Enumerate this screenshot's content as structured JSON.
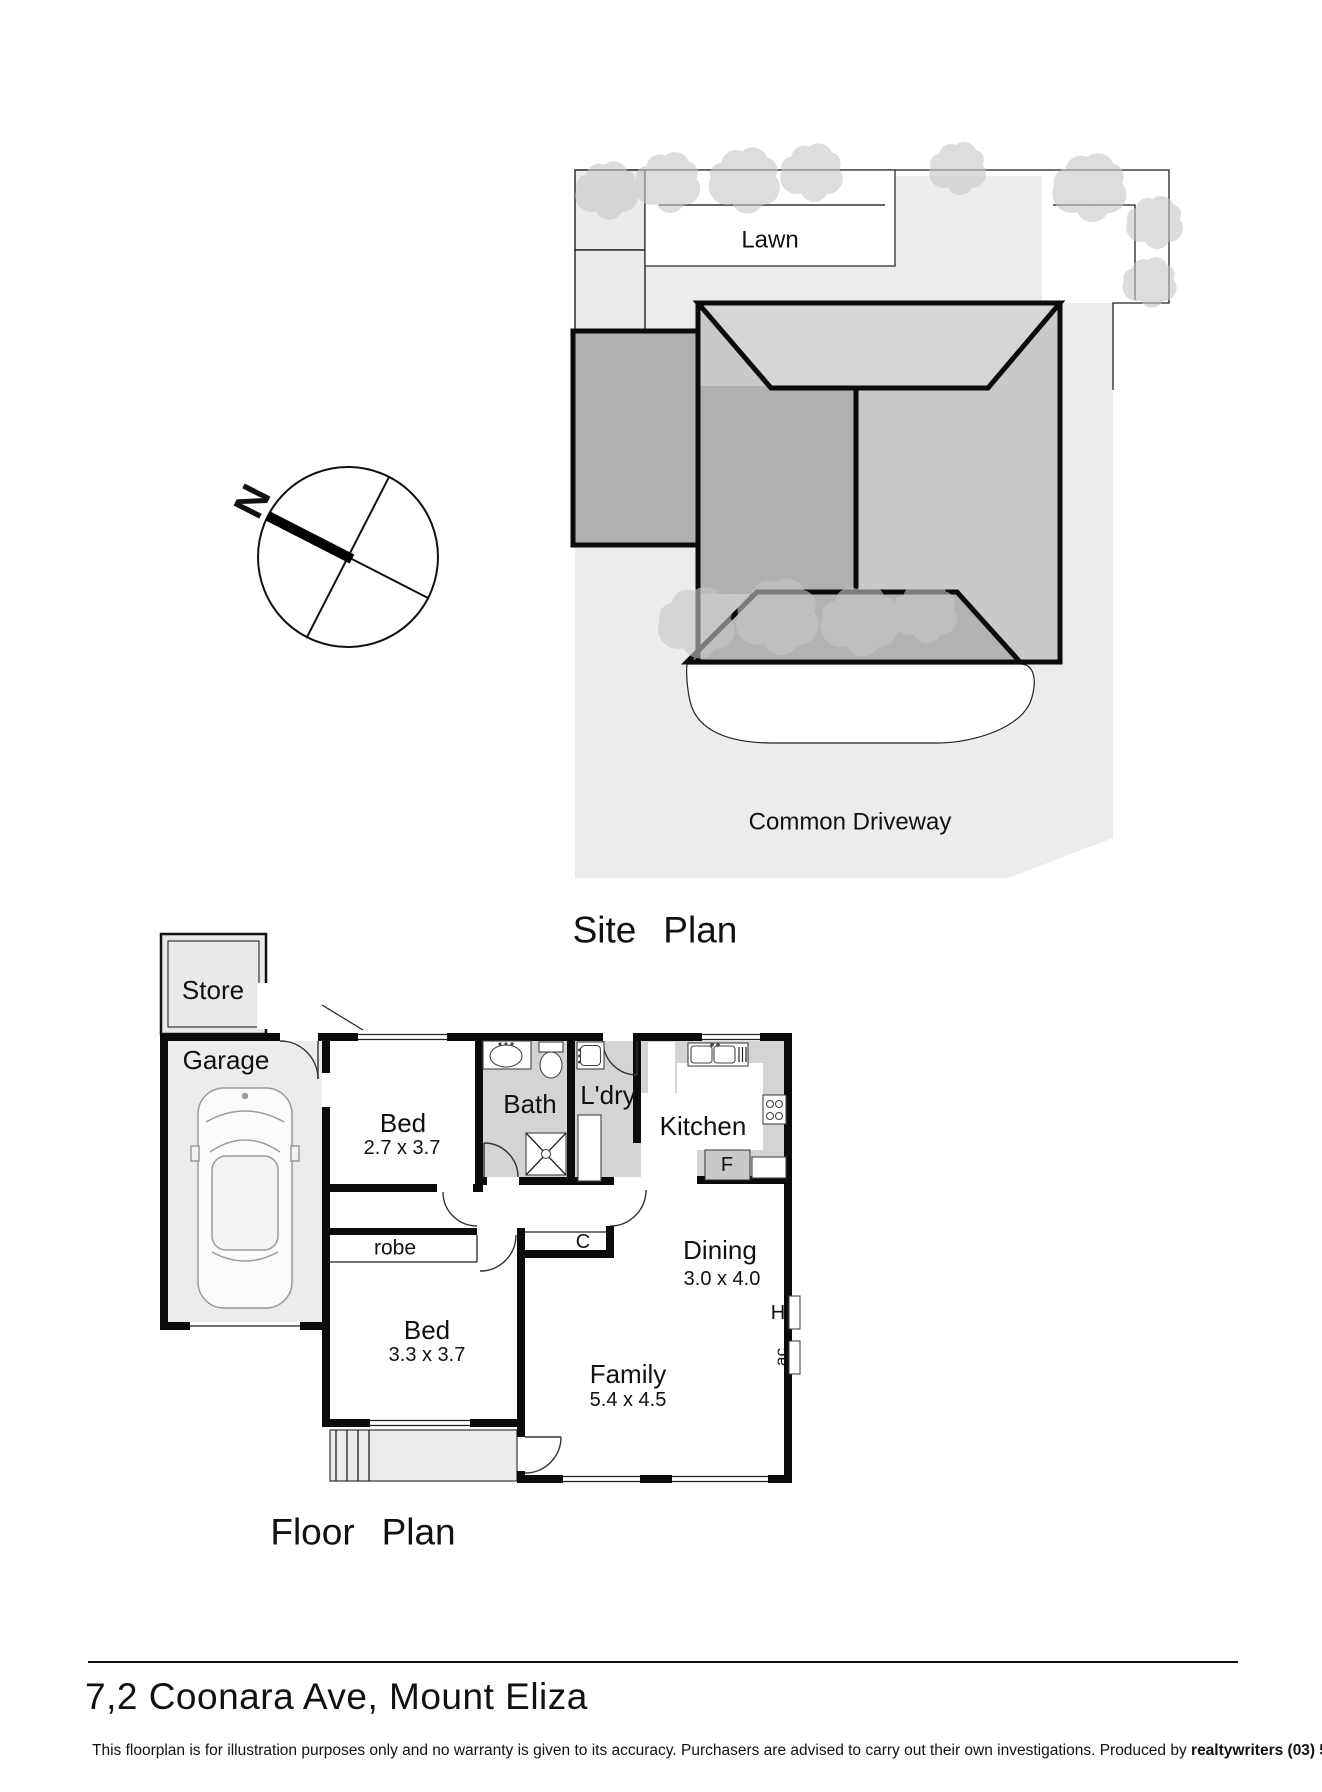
{
  "site_plan": {
    "title": "Site Plan",
    "lawn_label": "Lawn",
    "driveway_label": "Common Driveway",
    "compass_north": "N"
  },
  "floor_plan": {
    "title": "Floor Plan",
    "rooms": {
      "store": {
        "label": "Store"
      },
      "garage": {
        "label": "Garage"
      },
      "bed1": {
        "label": "Bed",
        "dimensions": "2.7 x 3.7"
      },
      "bed2": {
        "label": "Bed",
        "dimensions": "3.3 x 3.7"
      },
      "bath": {
        "label": "Bath"
      },
      "laundry": {
        "label": "L'dry"
      },
      "kitchen": {
        "label": "Kitchen"
      },
      "dining": {
        "label": "Dining",
        "dimensions": "3.0 x 4.0"
      },
      "family": {
        "label": "Family",
        "dimensions": "5.4 x 4.5"
      },
      "robe": {
        "label": "robe"
      }
    },
    "markers": {
      "cupboard": "C",
      "fridge": "F",
      "hot_water": "H",
      "air_conditioner": "ac"
    }
  },
  "footer": {
    "address": "7,2 Coonara Ave, Mount Eliza",
    "disclaimer_text": "This floorplan is for illustration purposes only and no warranty is given to its accuracy. Purchasers are advised to carry out their own investigations. Produced by ",
    "producer": "realtywriters (03) 5970 2222"
  },
  "colors": {
    "lot_gray": "#ececec",
    "roof_top": "#d6d6d6",
    "roof_side": "#c9c9c9",
    "roof_dark": "#b0b0b0",
    "wet_area_gray": "#d4d4d4",
    "wall_black": "#0b0b0b"
  }
}
